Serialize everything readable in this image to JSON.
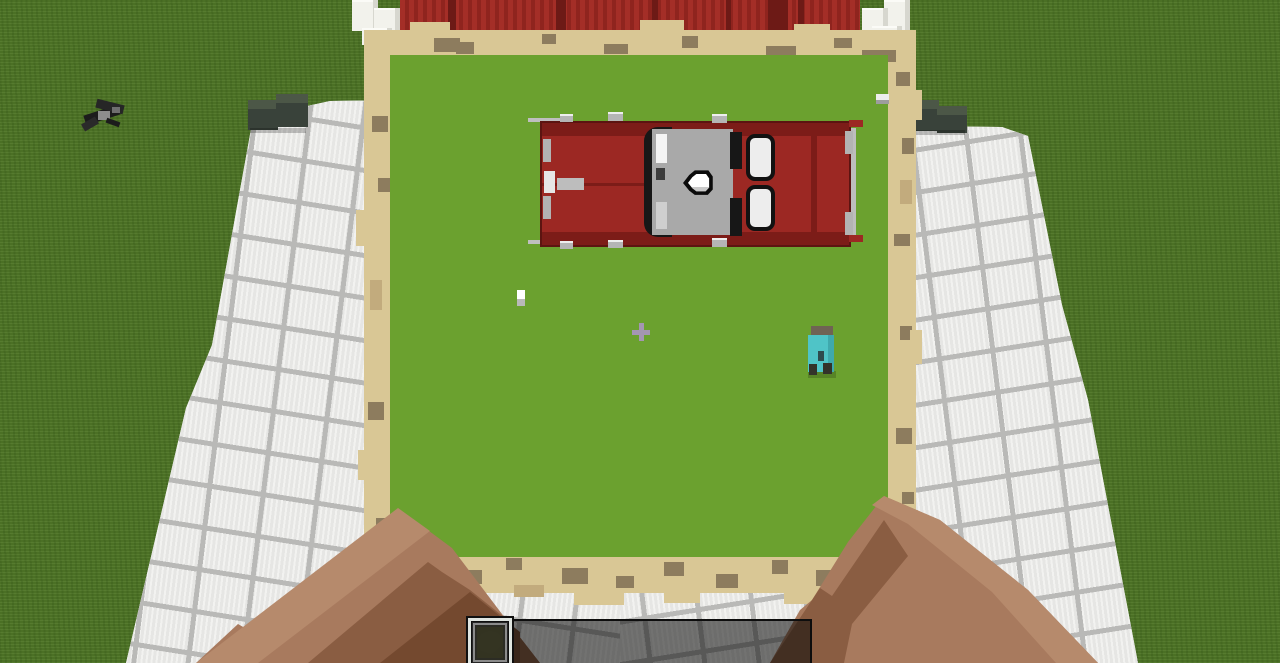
{
  "scene": {
    "view": "first-person holding filled map",
    "held_item": "filled_map",
    "world_features": [
      "grass-field",
      "white-tile-paths",
      "red-roof-building",
      "quartz-chimneys",
      "dark-hedge-blocks",
      "bat-entity-on-grass"
    ]
  },
  "map_view": {
    "content": "top-down red car build on green field",
    "markers": [
      {
        "type": "player-arrow-marker",
        "color": "#ffffff"
      },
      {
        "type": "small-white-dot-marker",
        "color": "#ffffff"
      },
      {
        "type": "cyan-banner-marker",
        "color": "#4fc4c7"
      },
      {
        "type": "white-block-marker",
        "color": "#ededed"
      }
    ]
  },
  "hud": {
    "crosshair": "plus",
    "hotbar": {
      "selected_index": 1,
      "slots": [
        {
          "item": "filled_map"
        },
        {
          "item": "filled_map"
        },
        {
          "item": "empty_map"
        },
        {
          "item": ""
        },
        {
          "item": ""
        },
        {
          "item": ""
        },
        {
          "item": ""
        },
        {
          "item": ""
        },
        {
          "item": ""
        }
      ]
    }
  },
  "colors": {
    "grass": "#4f7627",
    "mapgreen": "#6ba12f",
    "tan": "#d9c795",
    "tanmid": "#c2ab7d",
    "jag": "#8d7c5e",
    "roof": "#a42e27",
    "roofdark": "#6d1a16",
    "tile": "#ececea",
    "grout": "#b9b9b7",
    "quartz": "#f2f2ec",
    "hedge": "#39423a",
    "hedgetop": "#4c5747",
    "carred": "#9c2823",
    "cardark": "#7c1c18",
    "armlight": "#b68a6c",
    "armmid": "#a87a5e",
    "armdark": "#8a5d42",
    "armdarker": "#74492f",
    "cyan": "#4fc4c7",
    "crosshair": "#a496b2",
    "mapitem": "#d9d197",
    "emptymap": "#e9e4ab"
  }
}
